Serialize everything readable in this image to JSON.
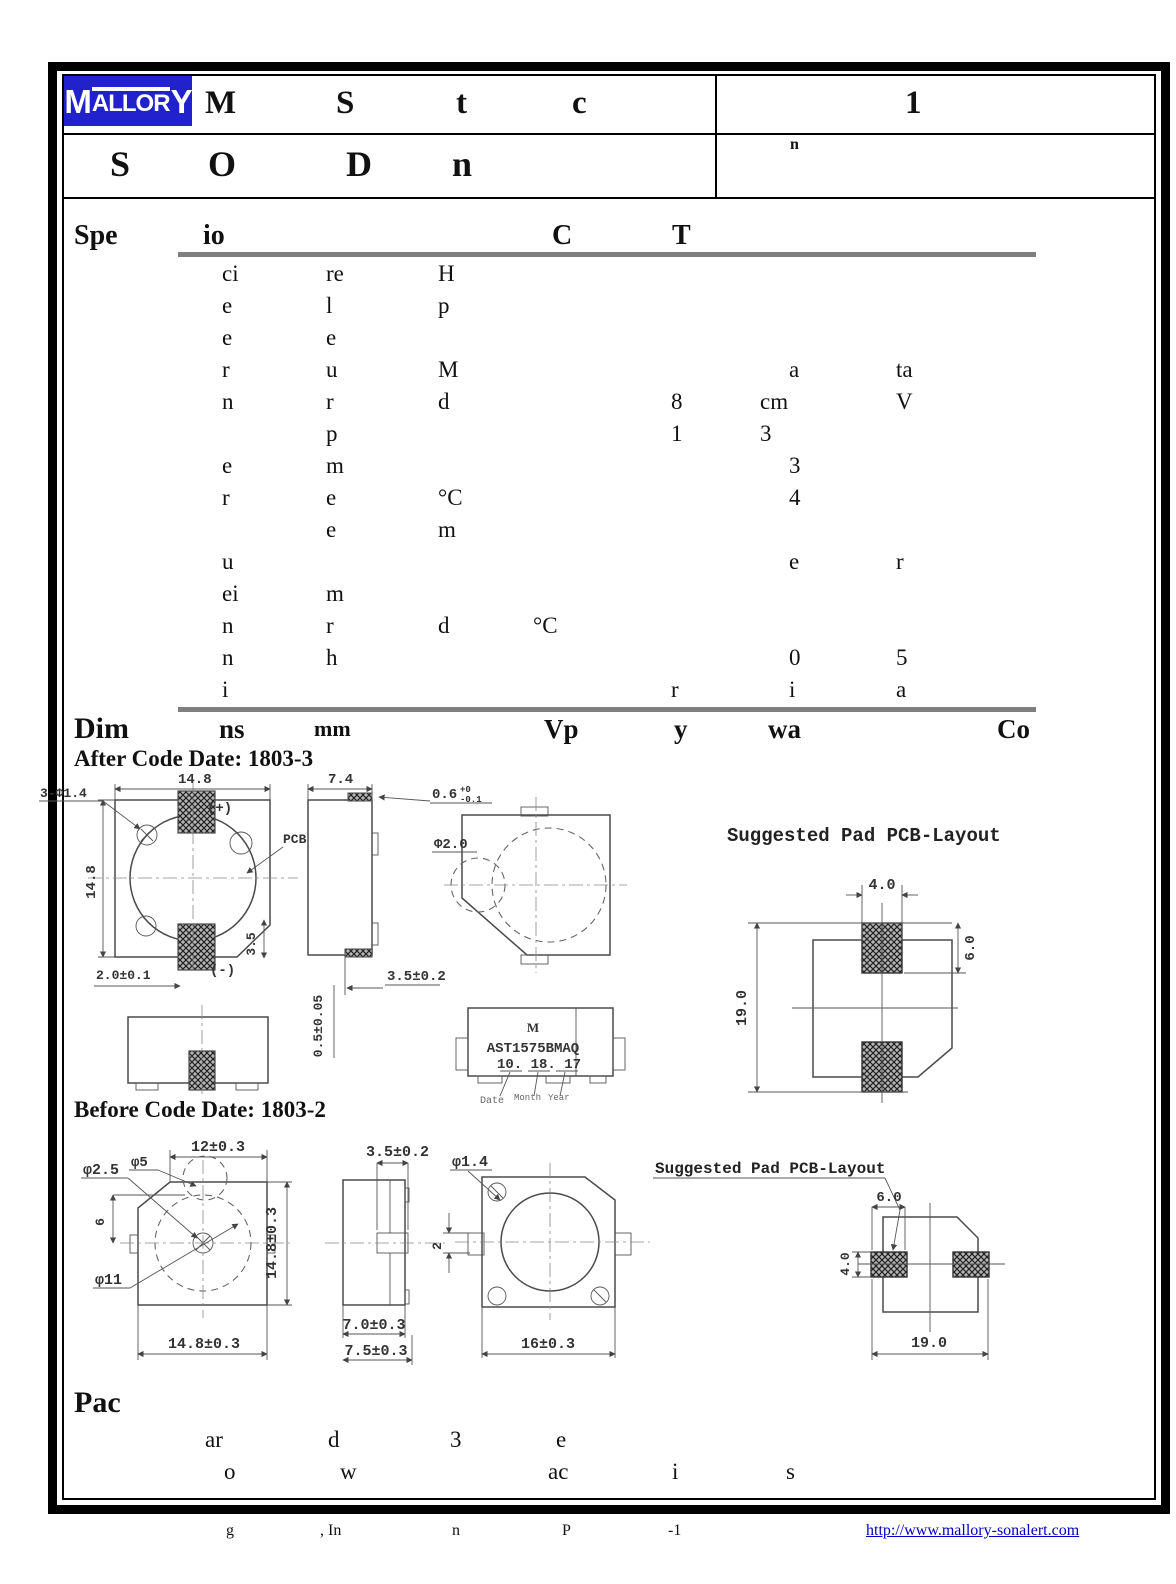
{
  "header": {
    "logo": {
      "first": "M",
      "middle": "ALLOR",
      "last": "Y"
    },
    "row1": {
      "f1": "M",
      "f2": "S",
      "f3": "t",
      "f4": "c",
      "right": "1"
    },
    "row2": {
      "f1": "S",
      "f2": "O",
      "f3": "D",
      "f4": "n",
      "right_sup": "n"
    }
  },
  "spec": {
    "h1": "Spe",
    "h2": "io",
    "h3": "C",
    "h4": "T",
    "rows": [
      {
        "a": "ci",
        "b": "re",
        "c": "H"
      },
      {
        "a": "e",
        "b": "l",
        "c": "p"
      },
      {
        "a": "e",
        "b": "e"
      },
      {
        "a": "r",
        "b": "u",
        "c": "M",
        "g": "a",
        "h": "ta"
      },
      {
        "a": "n",
        "b": "r",
        "c": "d",
        "e": "8",
        "f": "cm",
        "h": "V"
      },
      {
        "b": "p",
        "e": "1",
        "f": "3"
      },
      {
        "a": "e",
        "b": "m",
        "g": "3"
      },
      {
        "a": "r",
        "b": "e",
        "c": "°C",
        "g": "4"
      },
      {
        "b": "e",
        "c": "m"
      },
      {
        "a": "u",
        "g": "e",
        "h": "r"
      },
      {
        "a": "ei",
        "b": "m"
      },
      {
        "a": "n",
        "b": "r",
        "c": "d",
        "d": "°C"
      },
      {
        "a": "n",
        "b": "h",
        "g": "0",
        "h": "5"
      },
      {
        "a": "i",
        "e": "r",
        "g": "i",
        "h": "a"
      }
    ]
  },
  "dim": {
    "h1": "Dim",
    "h2": "ns",
    "h3": "mm",
    "h4": "Vp",
    "h5": "y",
    "h6": "wa",
    "h7": "Co",
    "after_label": "After Code Date: 1803-3",
    "before_label": "Before Code Date: 1803-2"
  },
  "after": {
    "top_view": {
      "dim_w": "14.8",
      "dim_h": "14.8",
      "holes": "3-Φ1.4",
      "plus": "(+)",
      "minus": "(-)",
      "pcb": "PCB",
      "dim_pad": "2.0±0.1",
      "dim_chamfer": "3.5"
    },
    "side_view": {
      "dim_w": "7.4",
      "tab_main": "0.6",
      "tab_tol_up": "+0",
      "tab_tol_dn": "-0.1",
      "dim_thk": "0.5±0.05",
      "dim_foot": "3.5±0.2"
    },
    "back_view": {
      "dia": "Φ2.0"
    },
    "marking": {
      "brand": "M",
      "part": "AST1575BMAQ",
      "code": "10. 18. 17",
      "lbl_date": "Date",
      "lbl_month": "Month",
      "lbl_year": "Year"
    },
    "pad": {
      "title": "Suggested Pad PCB-Layout",
      "w": "4.0",
      "h": "19.0",
      "pad_h": "6.0"
    }
  },
  "before": {
    "front_view": {
      "dim_top": "12±0.3",
      "dia1": "φ2.5",
      "dia2": "φ5",
      "dia3": "φ11",
      "dim6": "6",
      "dim_r": "14.8±0.3",
      "dim_b": "14.8±0.3"
    },
    "side_view": {
      "dim_top": "3.5±0.2",
      "dim_b1": "7.0±0.3",
      "dim_b2": "7.5±0.3"
    },
    "back_view": {
      "dia": "φ1.4",
      "dim2": "2",
      "dim_b": "16±0.3"
    },
    "pad": {
      "title": "Suggested Pad PCB-Layout",
      "w": "6.0",
      "h": "4.0",
      "span": "19.0"
    }
  },
  "pack": {
    "heading": "Pac",
    "r1": {
      "f1": "ar",
      "f2": "d",
      "f3": "3",
      "f4": "e"
    },
    "r2": {
      "f1": "o",
      "f2": "w",
      "f3": "ac",
      "f4": "i",
      "f5": "s"
    }
  },
  "footer": {
    "f1": "g",
    "f2": ", In",
    "f3": "n",
    "f4": "P",
    "f5": "-1",
    "link": "http://www.mallory-sonalert.com"
  }
}
